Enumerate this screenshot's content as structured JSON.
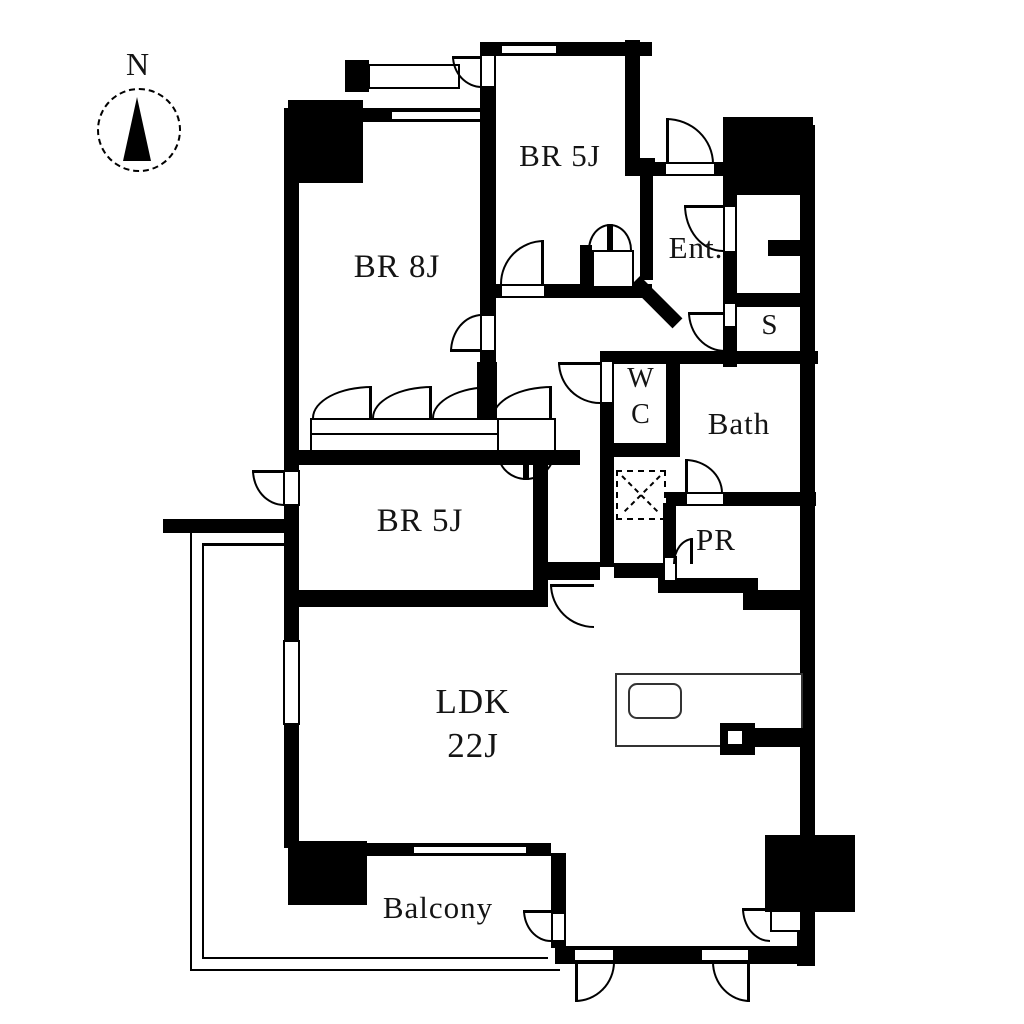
{
  "compass": {
    "label": "N"
  },
  "rooms": {
    "br5j_top": {
      "label": "BR 5J"
    },
    "br8j": {
      "label": "BR 8J"
    },
    "br5j_mid": {
      "label": "BR 5J"
    },
    "ldk": {
      "label": "LDK",
      "size": "22J"
    },
    "balcony": {
      "label": "Balcony"
    },
    "entrance": {
      "label": "Ent."
    },
    "storage": {
      "label": "S"
    },
    "wc": {
      "line1": "W",
      "line2": "C"
    },
    "bath": {
      "label": "Bath"
    },
    "powder_room": {
      "label": "PR"
    }
  },
  "colors": {
    "wall": "#000000",
    "background": "#ffffff",
    "text": "#141414"
  }
}
